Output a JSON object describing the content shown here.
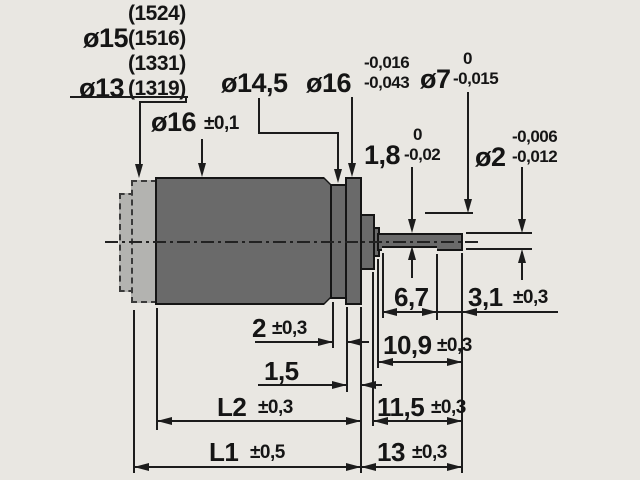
{
  "drawing_type": "motor dimension drawing",
  "variants": {
    "row1": "(1524)",
    "dia15_label": "ø15",
    "row2": "(1516)",
    "row3": "(1331)",
    "dia13_label": "ø13",
    "row4": "(1319)"
  },
  "diameters": {
    "body": {
      "label": "ø16",
      "tol": "±0,1"
    },
    "collar": {
      "label": "ø14,5"
    },
    "flange": {
      "label": "ø16",
      "tol_upper": "-0,016",
      "tol_lower": "-0,043"
    },
    "boss": {
      "label": "ø7",
      "tol_upper": "0",
      "tol_lower": "-0,015"
    },
    "flat": {
      "label": "1,8",
      "tol_upper": "0",
      "tol_lower": "-0,02"
    },
    "shaft": {
      "label": "ø2",
      "tol_upper": "-0,006",
      "tol_lower": "-0,012"
    }
  },
  "lengths": {
    "flat_section": {
      "value": "6,7"
    },
    "shaft_tip": {
      "value": "3,1",
      "tol": "±0,3"
    },
    "collar_width": {
      "value": "2",
      "tol": "±0,3"
    },
    "flange_width": {
      "value": "1,5"
    },
    "shaft_from_washer": {
      "value": "10,9",
      "tol": "±0,3"
    },
    "shaft_from_boss": {
      "value": "11,5",
      "tol": "±0,3"
    },
    "shaft_from_flange": {
      "value": "13",
      "tol": "±0,3"
    },
    "body_length": {
      "value": "L2",
      "tol": "±0,3"
    },
    "overall_length": {
      "value": "L1",
      "tol": "±0,5"
    }
  },
  "colors": {
    "paper": "#e9e7e2",
    "part_fill": "#6a6a6a",
    "ghost_fill": "#b3b3b0",
    "line": "#1c1c1c"
  }
}
